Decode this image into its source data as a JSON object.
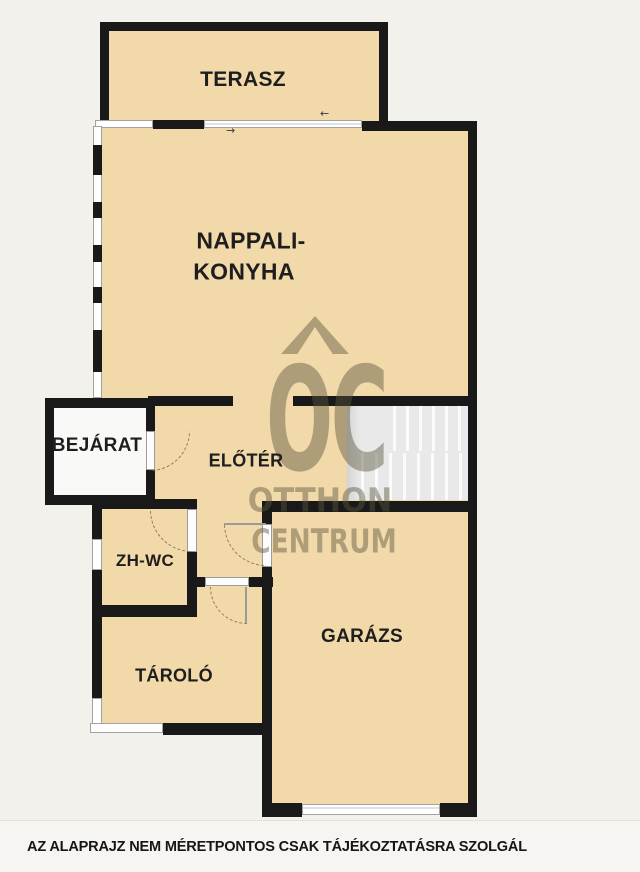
{
  "caption": "AZ ALAPRAJZ NEM MÉRETPONTOS CSAK TÁJÉKOZTATÁSRA SZOLGÁL",
  "rooms": {
    "terasz": "TERASZ",
    "nappali_line1": "NAPPALI-",
    "nappali_line2": "KONYHA",
    "bejarat": "BEJÁRAT",
    "eloter": "ELŐTÉR",
    "zhwc": "ZH-WC",
    "tarolo": "TÁROLÓ",
    "garazs": "GARÁZS"
  },
  "watermark": {
    "logo": "OC",
    "line1": "OTTHON",
    "line2": "CENTRUM"
  },
  "icons": {
    "slide_left": "←",
    "slide_right": "→"
  },
  "colors": {
    "floor": "#f2d9a9",
    "wall": "#191919",
    "page_background": "#f2f1ec",
    "stairs": "#e9e9e9",
    "entry_floor": "#f9f9f7",
    "watermark": "rgba(92,84,63,0.45)"
  }
}
